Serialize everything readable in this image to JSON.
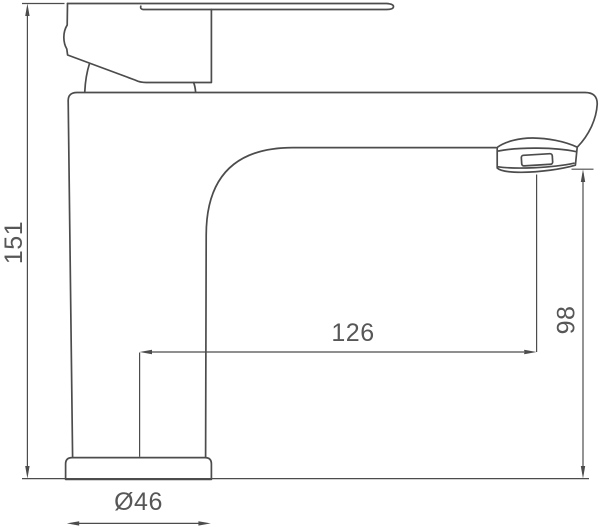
{
  "diagram": {
    "kind": "technical-dimension-drawing",
    "subject": "single-lever basin faucet, side view line drawing",
    "colors": {
      "line": "#4c4c4c",
      "text": "#575757",
      "background": "#ffffff"
    },
    "dimensions": {
      "total_height": {
        "label": "151",
        "value": 151,
        "orientation": "vertical",
        "position": "left"
      },
      "spout_reach": {
        "label": "126",
        "value": 126,
        "orientation": "horizontal",
        "position": "middle"
      },
      "spout_height": {
        "label": "98",
        "value": 98,
        "orientation": "vertical",
        "position": "right"
      },
      "base_diameter": {
        "label": "Ø46",
        "value": 46,
        "orientation": "horizontal",
        "position": "bottom"
      }
    }
  }
}
